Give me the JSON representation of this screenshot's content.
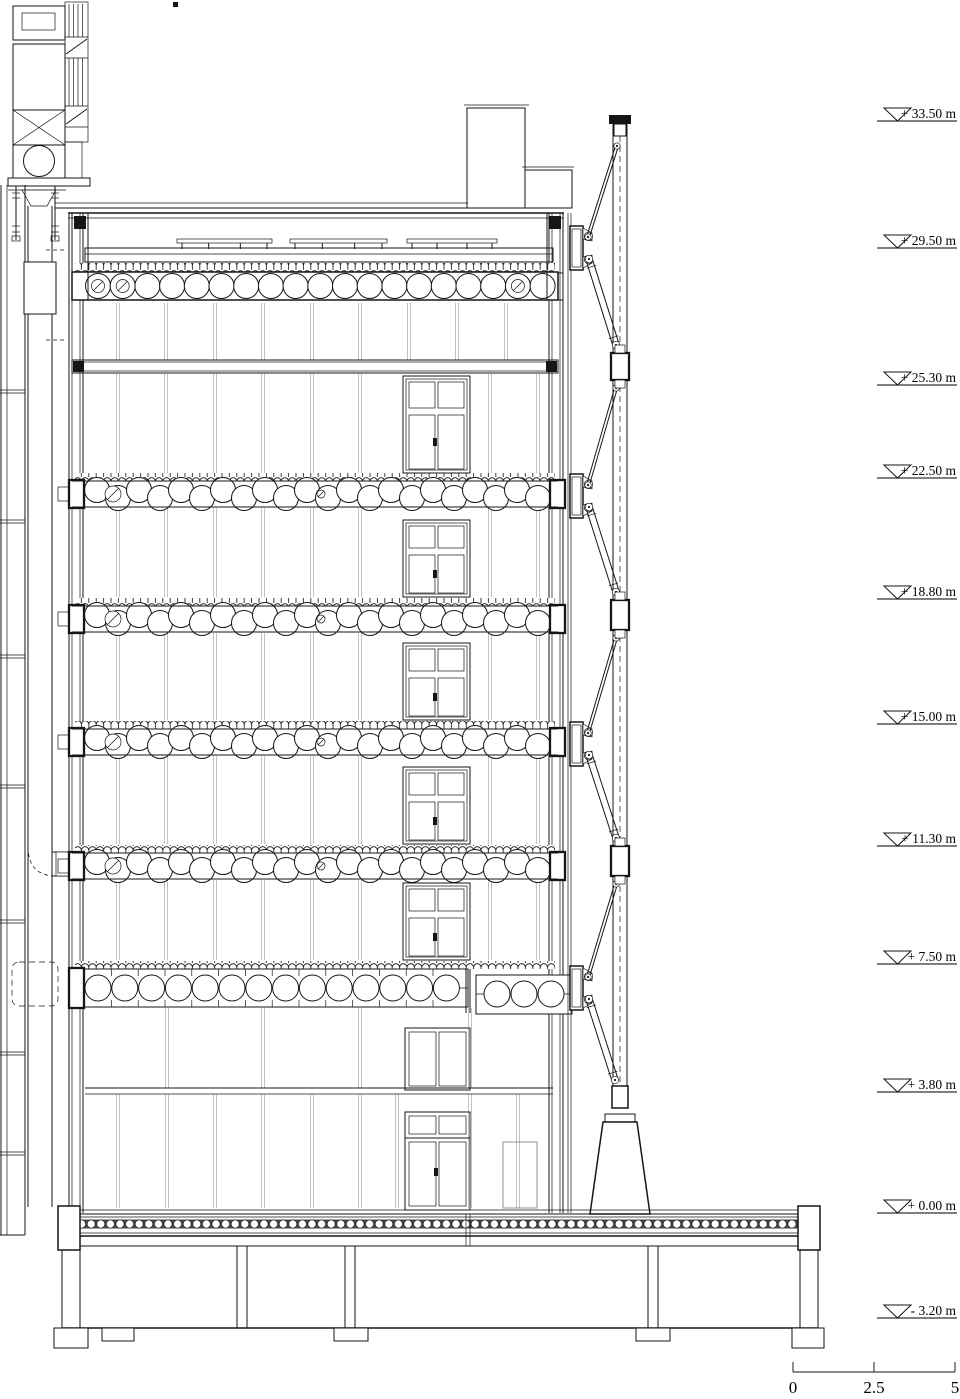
{
  "drawing": {
    "type": "architectural-building-section",
    "units": "m"
  },
  "elevation_markers": [
    {
      "label": "+ 33.50 m",
      "y": 121
    },
    {
      "label": "+ 29.50 m",
      "y": 248
    },
    {
      "label": "+ 25.30 m",
      "y": 385
    },
    {
      "label": "+ 22.50 m",
      "y": 478
    },
    {
      "label": "+ 18.80 m",
      "y": 599
    },
    {
      "label": "+ 15.00 m",
      "y": 724
    },
    {
      "label": "+ 11.30 m",
      "y": 846
    },
    {
      "label": "+ 7.50 m",
      "y": 964
    },
    {
      "label": "+ 3.80 m",
      "y": 1092
    },
    {
      "label": "+ 0.00 m",
      "y": 1213
    },
    {
      "label": "- 3.20 m",
      "y": 1318
    }
  ],
  "scale_bar": {
    "y": 1372,
    "ticks": [
      {
        "label": "0",
        "x": 793
      },
      {
        "label": "2.5",
        "x": 874
      },
      {
        "label": "5",
        "x": 955
      }
    ]
  }
}
